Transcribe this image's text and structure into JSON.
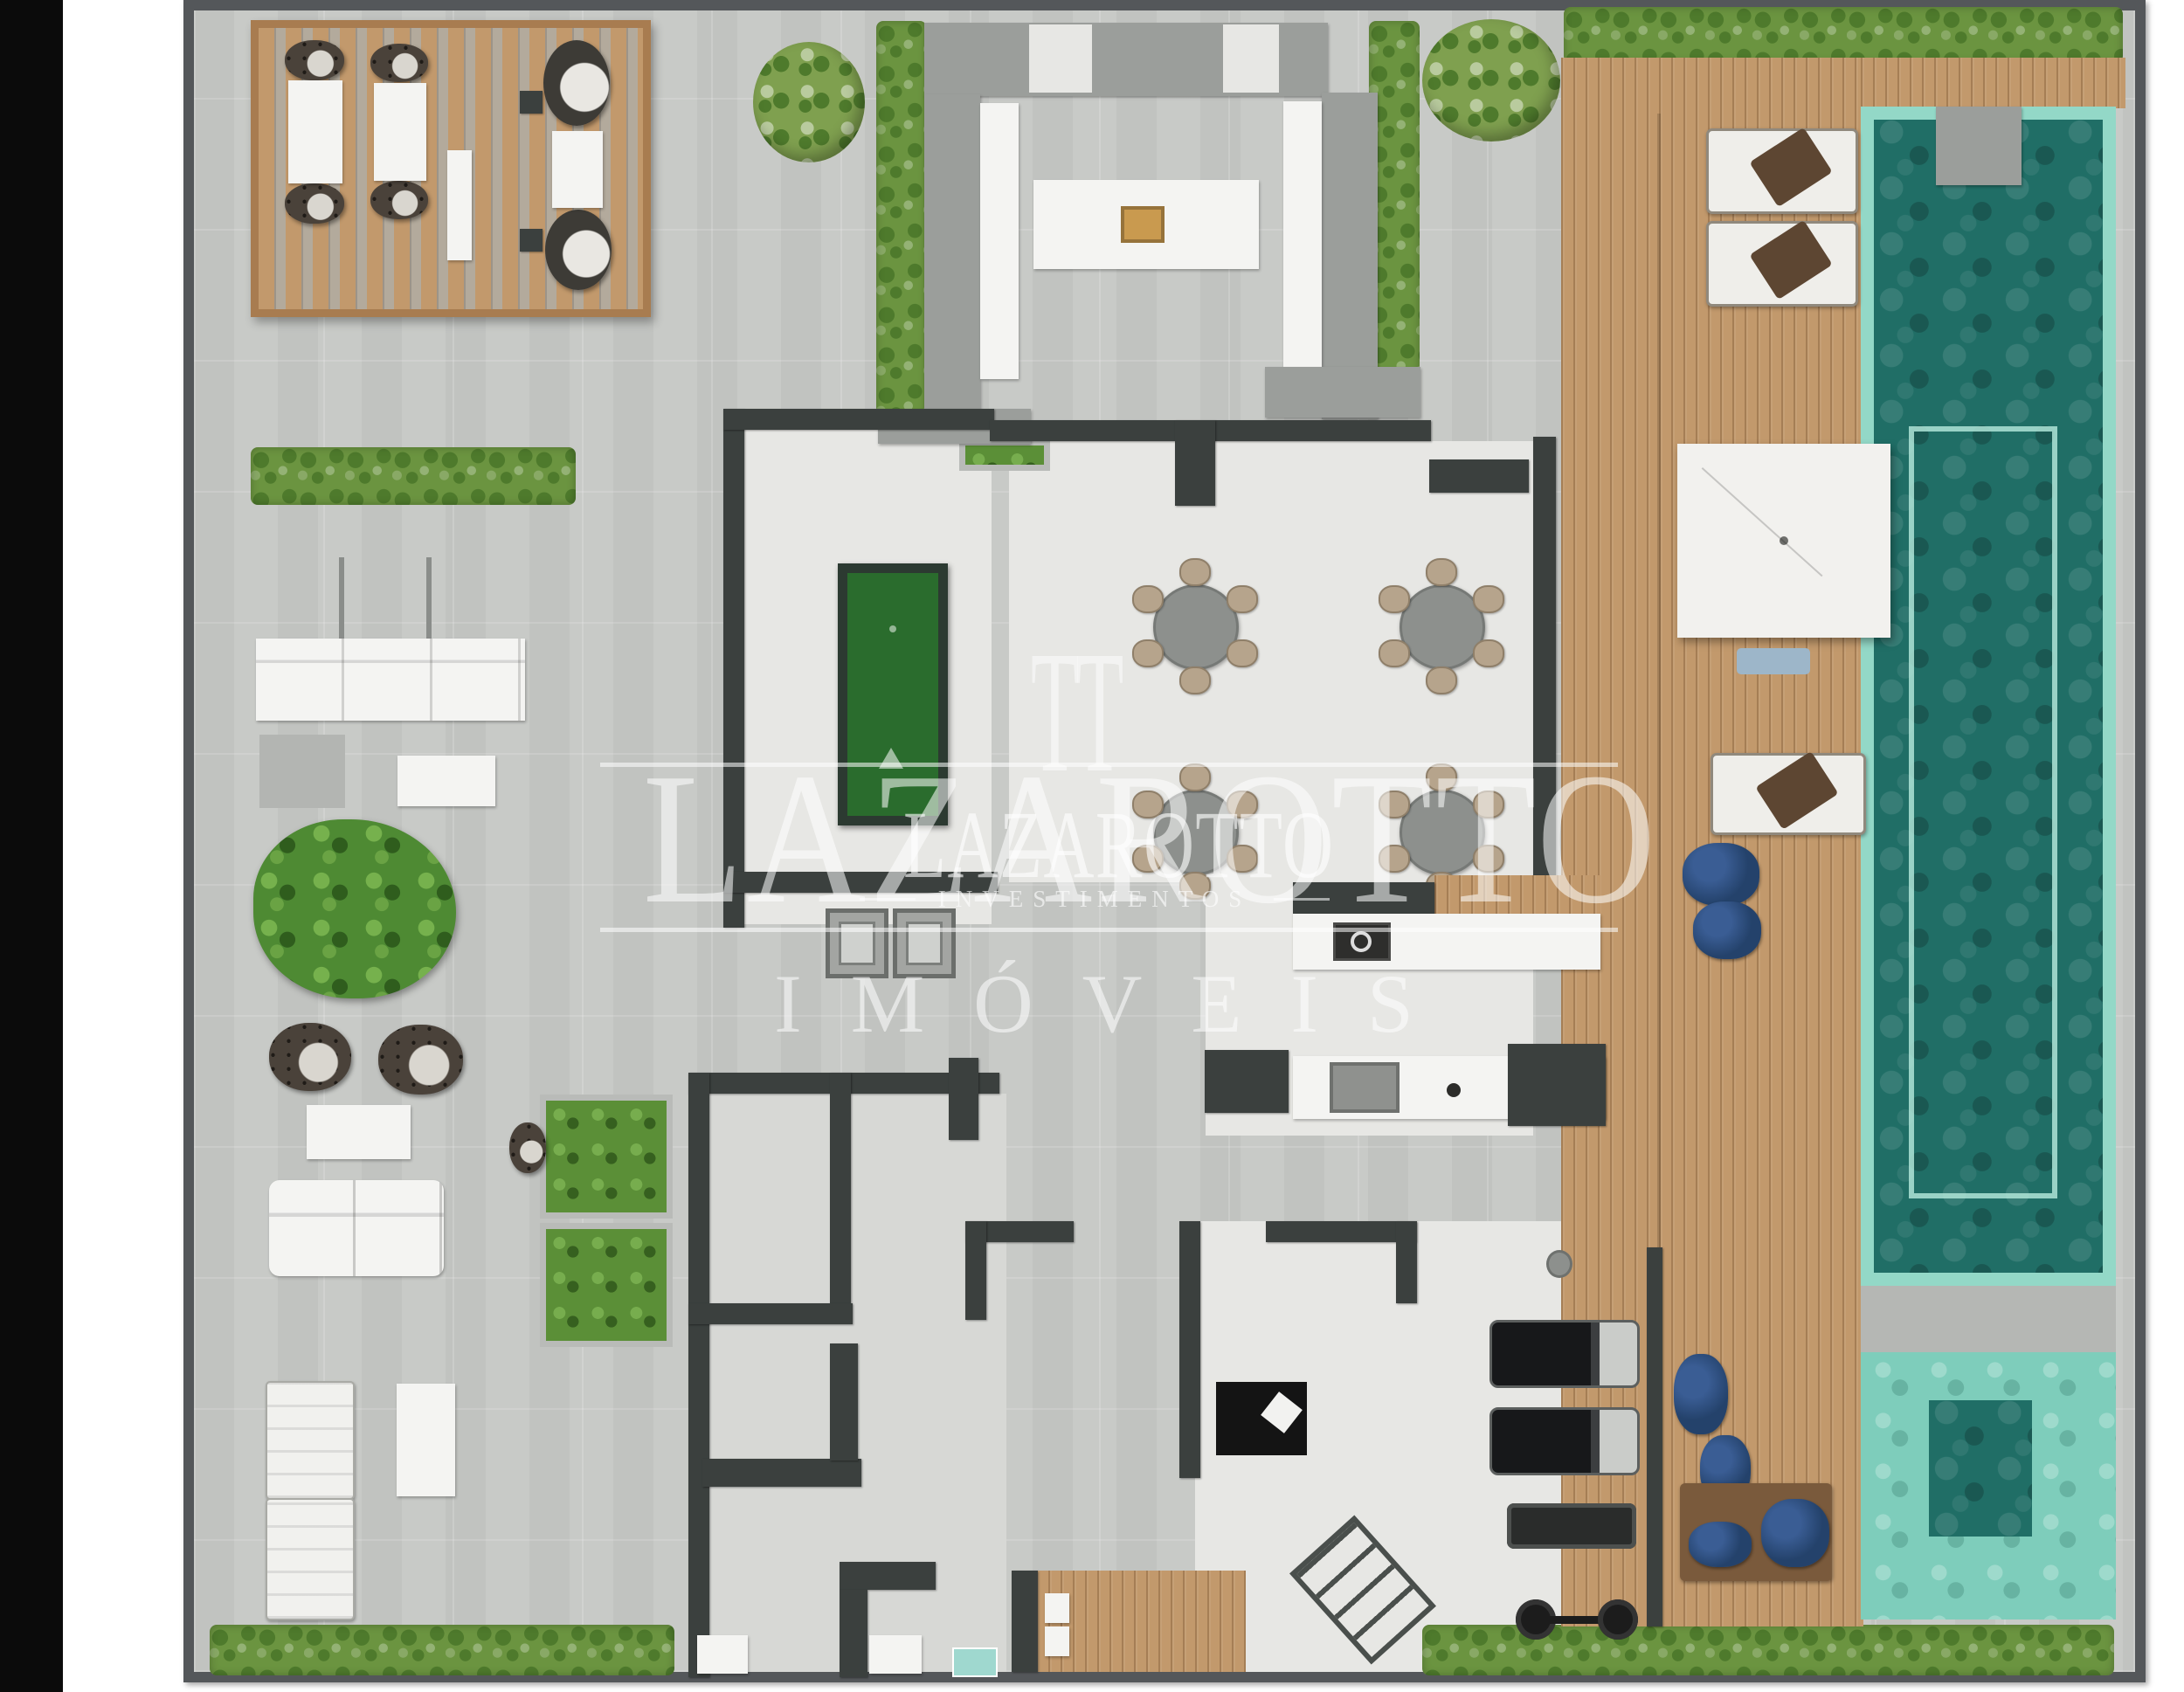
{
  "watermark": {
    "brand_large": "LAZAROTTO",
    "monogram": "TT",
    "brand_small": "LAZAROTTO",
    "division": "INVESTIMENTOS",
    "tagline": "IMÓVEIS"
  },
  "palette": {
    "page": "#ffffff",
    "black_strip": "#0b0b0b",
    "frame": "#54575a",
    "floor": "#c8cac7",
    "room_light": "#e7e7e4",
    "wall": "#3b403e",
    "structure": "#9b9e9b",
    "wood": "#c2996c",
    "wood_dark": "#a87c50",
    "hedge": "#6b9440",
    "leaf": "#4e7a2c",
    "aqua": "#93d8c7",
    "water": "#206e66",
    "shallow": "#7ecdbb",
    "felt": "#2a6c2d",
    "navy": "#24426b",
    "towel": "#5d4632",
    "tan": "#b6a48c",
    "white_counter": "#f4f4f2",
    "mat_brown": "#7a5a3c",
    "grill_tan": "#c99a4f",
    "teal_mat": "#9fd8cf"
  },
  "areas": {
    "pergola_lounge": "pergola-lounge",
    "gourmet_bar": "gourmet-bar",
    "dining_room": "dining-room",
    "games_room": "billiards-room",
    "kitchen": "kitchen",
    "gym": "gym",
    "sauna": "sauna",
    "elevator_core": "elevator-core",
    "pool": "lap-pool",
    "kids_pool": "kids-pool",
    "deck": "pool-deck",
    "garden": "hedges-and-planters"
  }
}
